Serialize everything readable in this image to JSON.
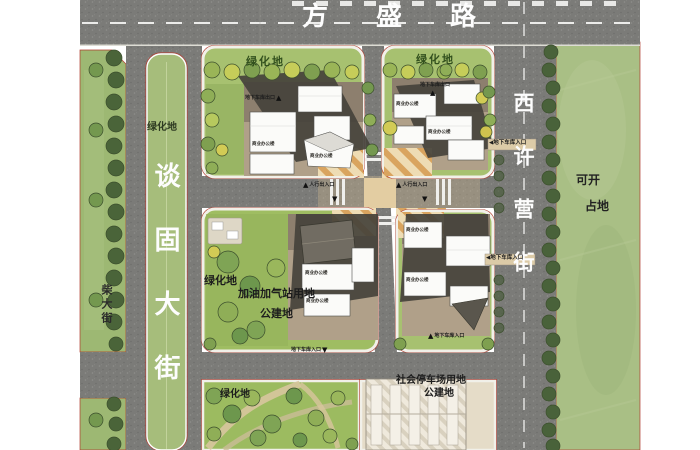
{
  "map": {
    "roads": {
      "top": "方盛路",
      "west": "谈固大街",
      "east": "西许营街",
      "southwest_branch": "柴大街"
    },
    "area_labels": {
      "green_space": "绿化地",
      "gas_station_line1": "加油加气站用地",
      "gas_station_line2": "公建地",
      "parking_lot_line1": "社会停车场用地",
      "parking_lot_line2": "公建地",
      "east_field_line1": "可开",
      "east_field_line2": "占地"
    },
    "entrances": {
      "garage_exit": "地下车库出口",
      "garage_entrance": "地下车库入口",
      "garage_entrance_west_arrow": "◀地下车库入口",
      "pedestrian": "人行出入口"
    },
    "buildings": {
      "commercial_office": "商业办公楼"
    },
    "markers": {
      "up": "▲",
      "down": "▼"
    },
    "colors": {
      "asphalt": "#7b7b78",
      "lawn": "#a7c170",
      "east_field": "#a9bf85",
      "courtyard": "#b0a089",
      "plaza_stripe": "#d9a45f",
      "red_boundary": "#b03a2e",
      "shadow": "#45423b",
      "building": "#fbfbf9"
    }
  }
}
